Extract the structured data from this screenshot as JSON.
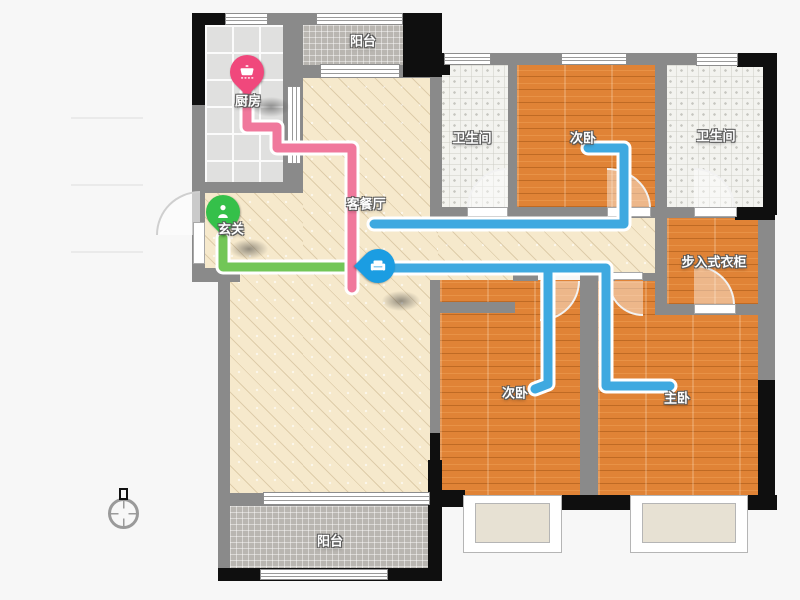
{
  "legend": {
    "items": [
      {
        "label": "来客动线",
        "value": "3.7m",
        "color": "#52cc33"
      },
      {
        "label": "居住动线",
        "value": "25.5m",
        "color": "#00a6e8"
      },
      {
        "label": "家务动线",
        "value": "6.0m",
        "color": "#f04878"
      }
    ]
  },
  "rooms": {
    "kitchen": {
      "label": "厨房"
    },
    "balcony_top": {
      "label": "阳台"
    },
    "bathroom_left": {
      "label": "卫生间"
    },
    "bedroom_top": {
      "label": "次卧"
    },
    "bathroom_right": {
      "label": "卫生间"
    },
    "living_dining": {
      "label": "客餐厅"
    },
    "entrance": {
      "label": "玄关"
    },
    "walkin_closet": {
      "label": "步入式衣柜"
    },
    "bedroom_bottom": {
      "label": "次卧"
    },
    "master_bedroom": {
      "label": "主卧"
    },
    "balcony_bottom": {
      "label": "阳台"
    }
  },
  "pins": [
    {
      "location": "厨房",
      "icon": "pot-icon",
      "color": "#f0487c"
    },
    {
      "location": "玄关",
      "icon": "person-icon",
      "color": "#35c04a"
    },
    {
      "location": "客餐厅",
      "icon": "sofa-icon",
      "color": "#1b9de2"
    }
  ],
  "routes": [
    {
      "name": "来客动线",
      "length": "3.7m",
      "line_color": "#72c657"
    },
    {
      "name": "居住动线",
      "length": "25.5m",
      "line_color": "#3fa9e0"
    },
    {
      "name": "家务动线",
      "length": "6.0m",
      "line_color": "#f0789c"
    }
  ],
  "compass": {
    "icon": "north-compass-icon"
  }
}
